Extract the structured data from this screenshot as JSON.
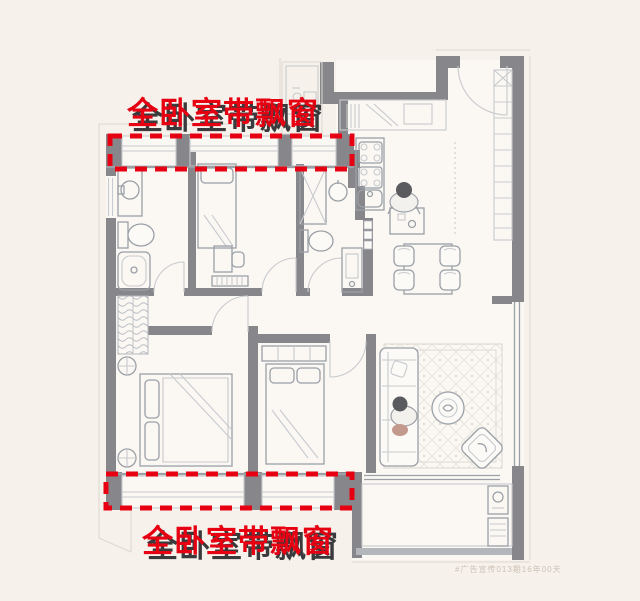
{
  "page": {
    "width": 640,
    "height": 601,
    "type": "real-estate floor plan advertisement"
  },
  "captions": {
    "top": "全卧室带飘窗",
    "bottom": "全卧室带飘窗"
  },
  "watermark": "#广告宣传013期16年00天",
  "colors": {
    "accent_red": "#e60012",
    "caption_shadow": "#3a3a3c",
    "wall": "#87878b",
    "furniture_line": "#9aa0a6",
    "light_line": "#c7cace",
    "faint": "#ddd8d1",
    "paper": "#f6f1ea",
    "floor": "#fbf8f4"
  },
  "highlights": {
    "description": "red dashed boxes marking bay windows of all bedrooms",
    "top_box": {
      "x": 110,
      "y": 136,
      "w": 242,
      "h": 33
    },
    "bottom_box": {
      "x": 106,
      "y": 474,
      "w": 246,
      "h": 34
    },
    "stroke_width": 5,
    "dash_pattern": "12 8"
  },
  "floorplan_elements": [
    "bay-window",
    "bathroom-vanity",
    "toilet",
    "bathtub",
    "single-bed",
    "double-bed",
    "wardrobe",
    "shower-stall",
    "washbasin",
    "kitchen-stove",
    "kitchen-sink",
    "kitchen-counter",
    "utility-niche",
    "dining-table",
    "dining-chair",
    "person-standing",
    "person-sitting",
    "sofa",
    "coffee-table",
    "armchair",
    "area-rug",
    "entry-door",
    "interior-door",
    "entry-cabinet",
    "radiator",
    "desk",
    "desk-chair",
    "closet",
    "floor-lamp",
    "balcony",
    "laundry-sink",
    "washing-machine",
    "sliding-door",
    "window"
  ]
}
